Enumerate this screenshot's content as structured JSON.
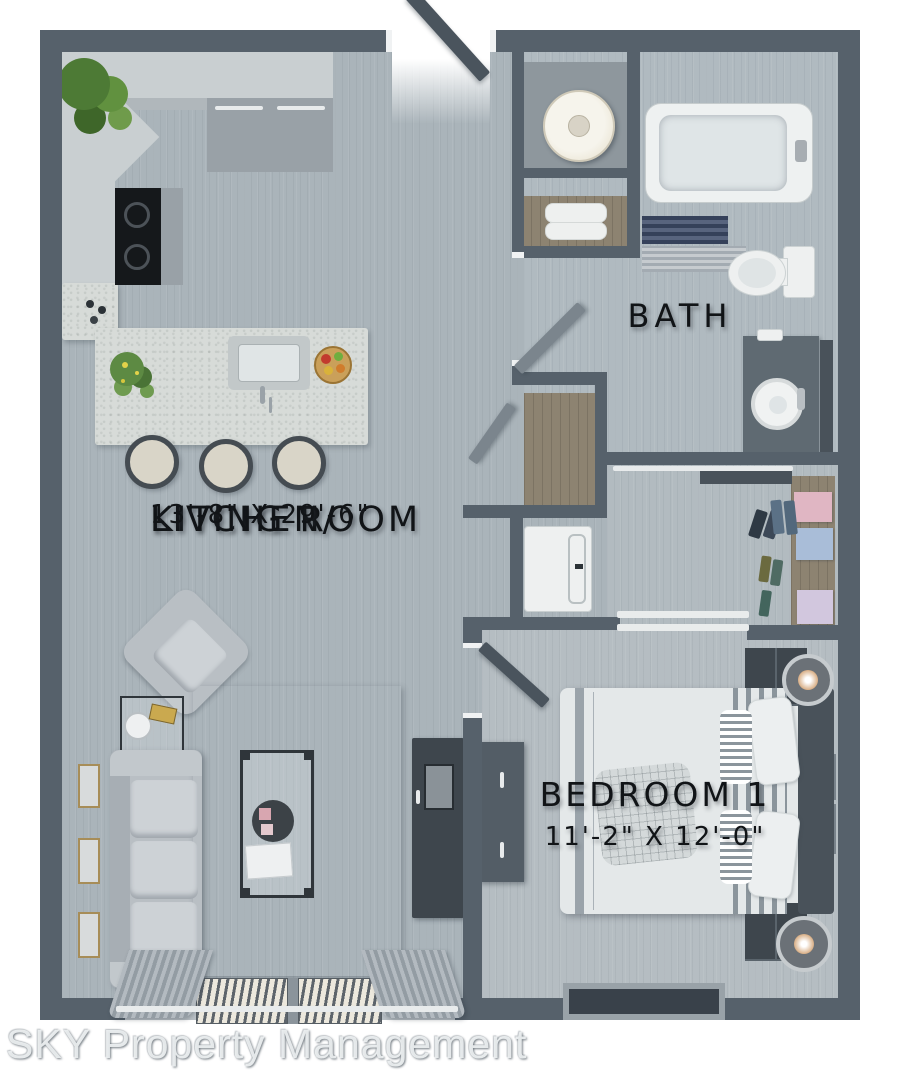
{
  "watermark": "SKY Property Management",
  "rooms": {
    "kitchen_living": {
      "line1": "KITCHEN/",
      "line2": "LIVING ROOM",
      "dims": "13'-8\" X 29'-6\""
    },
    "bath": {
      "name": "BATH"
    },
    "bedroom": {
      "name": "BEDROOM 1",
      "dims": "11'-2\" X 12'-0\""
    }
  },
  "colors": {
    "wall": "#56616b",
    "floor_main": "#aab4ba",
    "floor_bath": "#b0bac0",
    "floor_bedroom": "#b5bdc2",
    "floor_closet": "#b2bbc0",
    "counter": "#c9cfd1",
    "island": "#d7dbd8",
    "stainless": "#99a1a7",
    "wood": "#8d8371",
    "sofa": "#b9bfc4",
    "cushion": "#cdd2d6",
    "dark_furniture": "#3e464d",
    "bed_white": "#e4e8e9",
    "headboard": "#49525a",
    "door": "#4a545d",
    "jamb": "#f0f2f3",
    "track": "#e9ecec",
    "label": "#111417",
    "box_pink": "#e0b6c3",
    "box_blue": "#a9bdd8",
    "box_lavender": "#d2c7de"
  },
  "rug": {
    "palette": [
      "#d8d2c3",
      "#c7c0af",
      "#a49c8a",
      "#bab3a3",
      "#7b746a",
      "#464540",
      "#928b7c",
      "#c3c0b5"
    ],
    "pattern": [
      "3104620",
      "0257413",
      "4630152",
      "1345706",
      "5012364",
      "2476031",
      "0153247",
      "6240515",
      "3516402",
      "1062753"
    ]
  }
}
